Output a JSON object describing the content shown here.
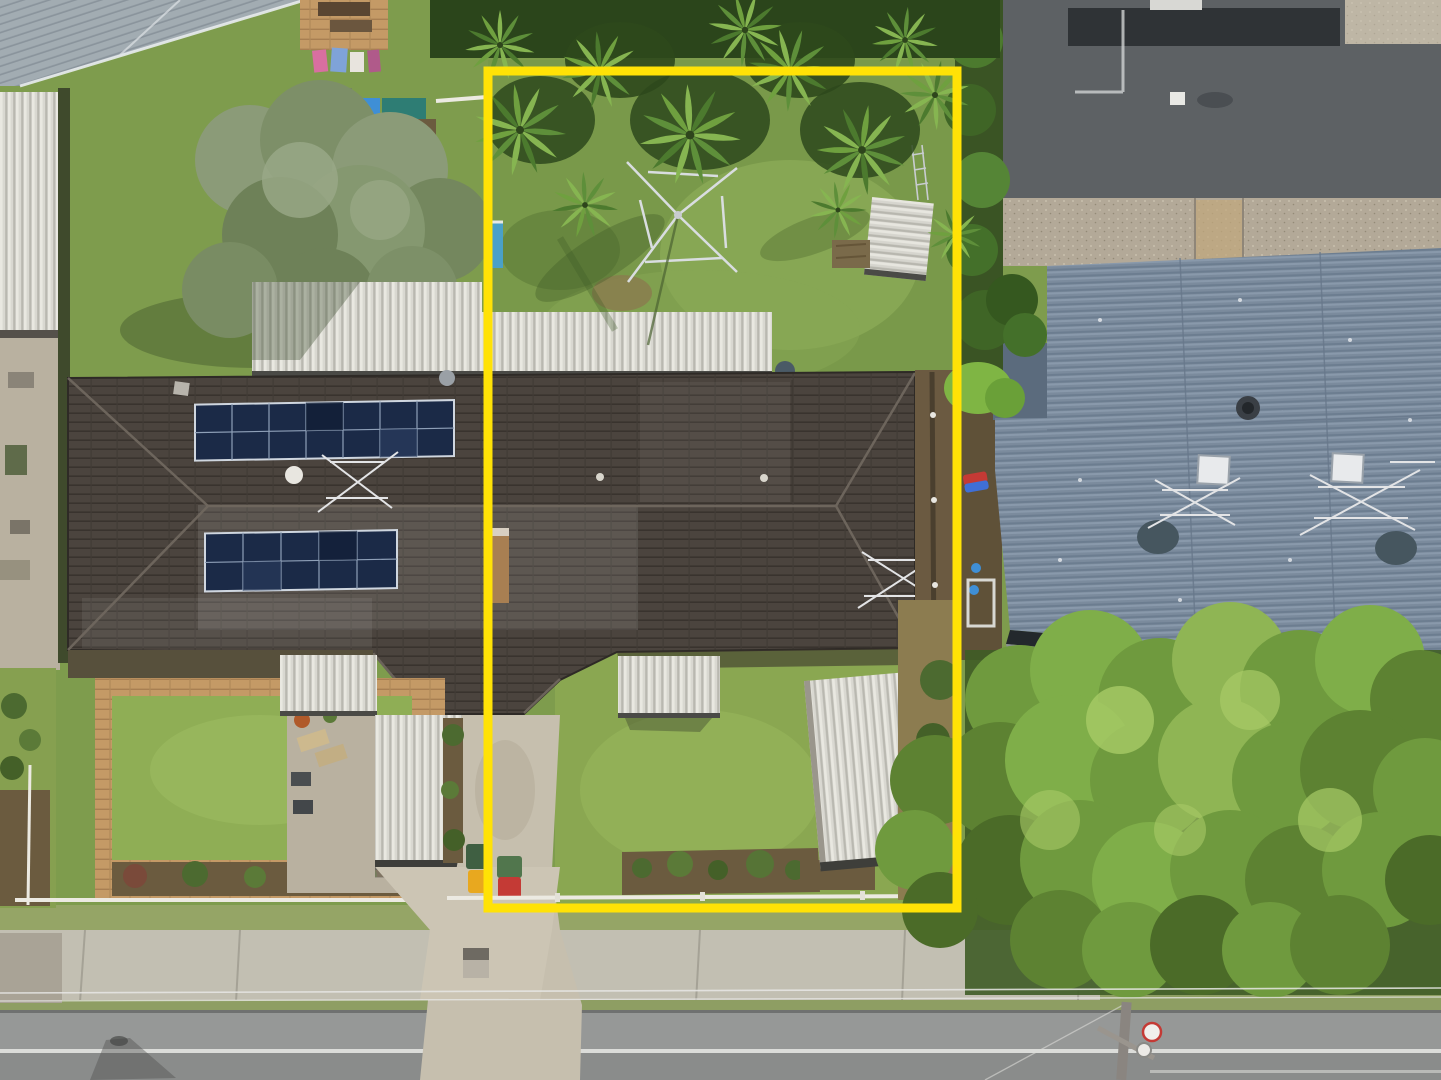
{
  "title": "Aerial drone photo of residential properties with highlighted lot boundary",
  "palette": {
    "boundary_yellow": "#ffe206",
    "roof_dark": "#4b443e",
    "roof_hip_light": "#6f675e",
    "metal_white": "#d9d8d1",
    "blue_roof": "#7b8b9d",
    "blue_roof_dark": "#5b6b7d",
    "grass_base": "#7e9c4d",
    "grass_back": "#79994a",
    "grass_front": "#8aa751",
    "grass_bright": "#9ab95d",
    "tree_green": "#6f9a3e",
    "tree_light": "#8fb554",
    "tree_dark": "#4b6b28",
    "tree_gray": "#8b9b78",
    "palm_green": "#5e8f3a",
    "palm_light": "#86b551",
    "solar_blue": "#1b2a47",
    "drive_concrete": "#c6bfae",
    "courtyard_gray": "#b9b1a0",
    "footpath": "#c2bfb2",
    "road": "#969897",
    "asphalt_dark": "#5d6164",
    "aggregate": "#b3a998",
    "mulch": "#6b5b3f",
    "leaf_litter": "#8c7c50",
    "brick": "#c49a66",
    "tile_gray": "#a2acb2",
    "skylight": "#e8eaec",
    "bin_yellow": "#e8a81f",
    "bin_red": "#c43a35",
    "bin_green": "#51764d",
    "bin_green_dark": "#3f5f42",
    "tarp_blue": "#3f8fd6",
    "tarp_teal": "#2e7d74",
    "pool_blue": "#4aa0c8",
    "chimney_tan": "#a87f52",
    "white_line": "#e8e8e4",
    "fence_white": "#eceae2"
  },
  "boundary": {
    "shape": "rectangle",
    "style": "solid outline",
    "meaning": "highlighted property lot"
  },
  "scene": {
    "objects": [
      "subject-lot-boundary",
      "duplex-dark-tile-roof",
      "solar-panel-array-upper",
      "solar-panel-array-lower",
      "tv-antennas",
      "rotary-clothesline",
      "backyard-lawn",
      "garden-shed",
      "palm-trees",
      "white-carport-left-unit",
      "white-carport-subject",
      "rear-patio-awning",
      "concrete-driveway",
      "wheelie-bins",
      "front-fence-white",
      "front-garden-bed",
      "left-neighbor-gray-tile-roof",
      "left-neighbor-backyard-tree",
      "right-neighbor-blue-metal-roof",
      "skylights",
      "satellite-dishes",
      "large-street-tree",
      "top-right-asphalt-parking",
      "street-road",
      "footpath",
      "power-lines",
      "power-pole",
      "letterbox"
    ]
  }
}
